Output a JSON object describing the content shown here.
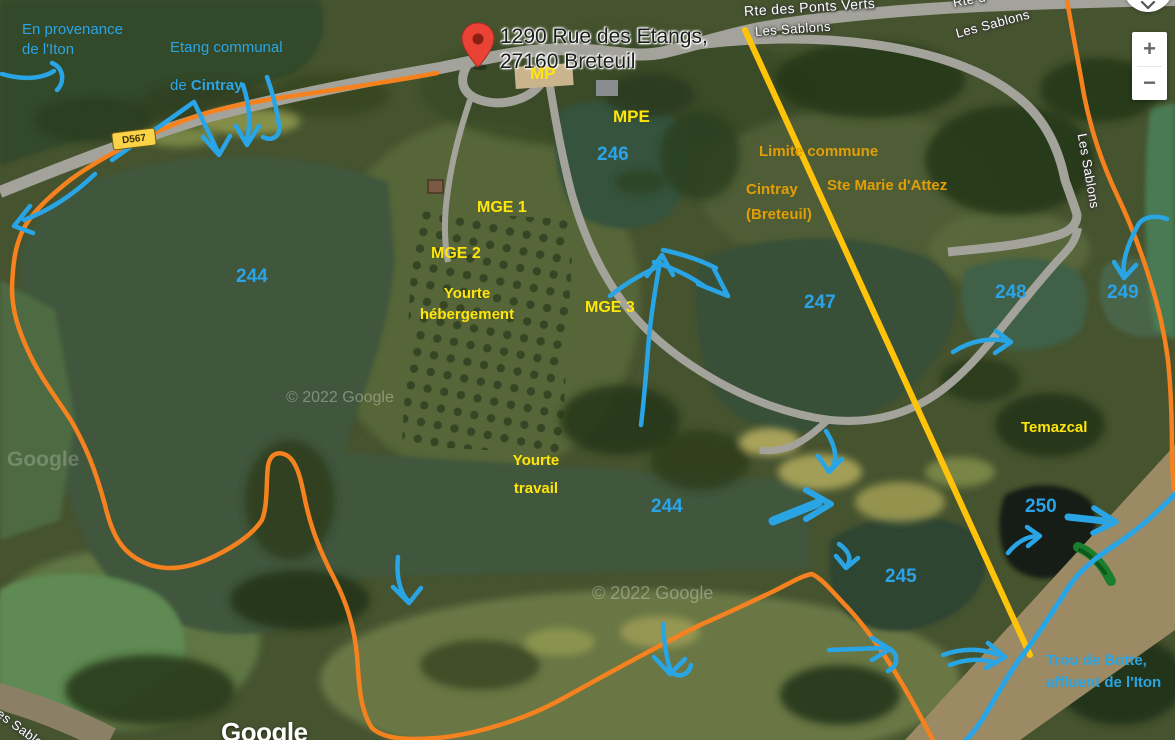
{
  "pin_label": {
    "line1": "1290 Rue des Etangs,",
    "line2": "27160 Breteuil"
  },
  "roads": {
    "rte_ponts_verts": "Rte des Ponts Verts",
    "les_sablons_1": "Les Sablons",
    "les_sablons_2": "Les Sablons",
    "les_sablons_vertical": "Les Sablons",
    "les_sablons_bottom": "Les Sablons",
    "rte_partial": "Rte d",
    "d567_badge": "D567"
  },
  "ponds": {
    "p244_left": "244",
    "p244_center": "244",
    "p245": "245",
    "p246": "246",
    "p247": "247",
    "p248": "248",
    "p249": "249",
    "p250": "250"
  },
  "labels_yellow": {
    "mp": "MP",
    "mpe": "MPE",
    "mge1": "MGE 1",
    "mge2": "MGE 2",
    "mge3": "MGE 3",
    "yourte_hebergement": "Yourte\nhébergement",
    "yourte_travail": "Yourte\ntravail",
    "temazcal": "Temazcal"
  },
  "labels_orange": {
    "limite_commune": "Limite commune",
    "cintray_breteuil": "Cintray\n(Breteuil)",
    "ste_marie": "Ste Marie d'Attez"
  },
  "labels_blue": {
    "provenance": "En provenance\nde l'Iton",
    "etang_line1": "Etang communal",
    "etang_line2_prefix": "de ",
    "etang_line2_bold": "Cintray",
    "trou_de_botte": "Trou de Botte,\naffluent de l'Iton"
  },
  "watermarks": {
    "google_logo": "Google",
    "google_faint": "Google",
    "copyright_1": "© 2022 Google",
    "copyright_2": "© 2022 Google"
  },
  "controls": {
    "zoom_in": "+",
    "zoom_out": "−"
  },
  "colors": {
    "annotation_blue": "#29A5E5",
    "annotation_yellow": "#FFE50A",
    "annotation_orange": "#E19E06",
    "boundary_orange": "#F5821F",
    "commune_line_yellow": "#FFC40A",
    "green_mark": "#1B7E2C",
    "pin_red": "#EA4335"
  }
}
